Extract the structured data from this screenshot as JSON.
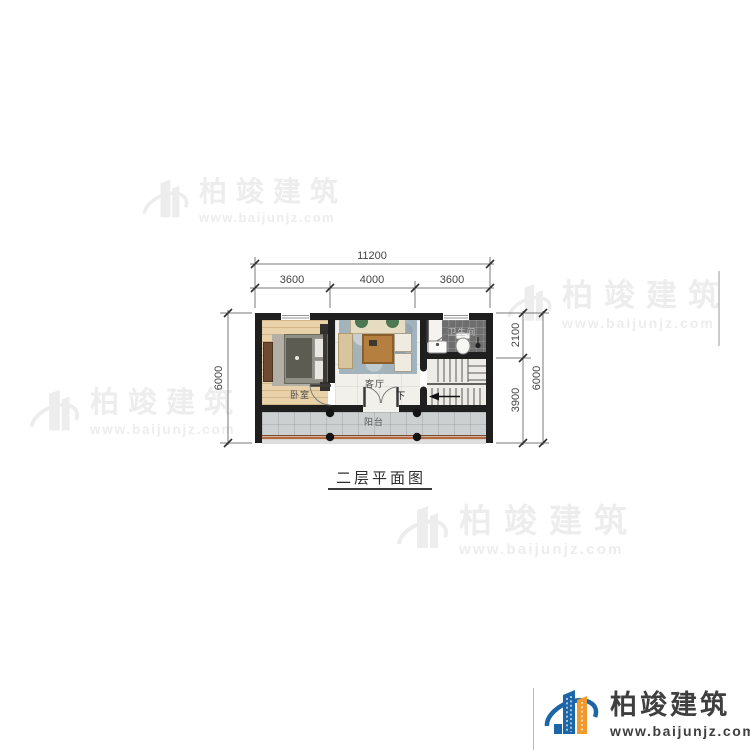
{
  "title": {
    "text": "二层平面图"
  },
  "brand": {
    "name": "柏竣建筑",
    "url": "www.baijunjz.com"
  },
  "dims": {
    "top_total": "11200",
    "top_segments": [
      "3600",
      "4000",
      "3600"
    ],
    "left_total": "6000",
    "right_segments": [
      "2100",
      "3900"
    ],
    "right_total": "6000"
  },
  "rooms": {
    "bedroom": "卧室",
    "living_room": "客厅",
    "bathroom": "卫生间",
    "balcony": "阳台",
    "stairs_down": "下"
  },
  "colors": {
    "wall": "#1f1f1f",
    "logo_blue": "#1b66a8",
    "logo_orange": "#f2992e",
    "railing_brown": "#b06a42",
    "watermark_gray": "#ededed",
    "bath_floor": "#6e6e6e",
    "bedroom_floor": "#e9d2a9"
  }
}
